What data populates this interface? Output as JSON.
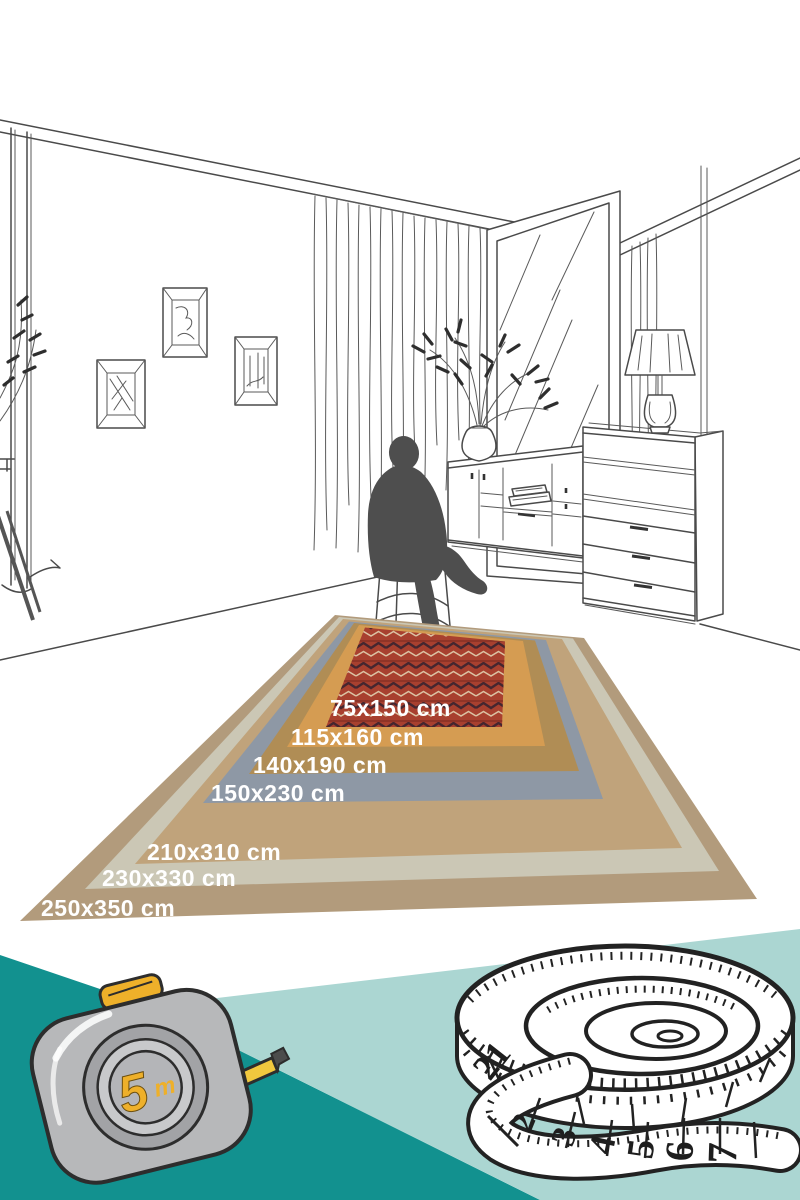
{
  "rugs": [
    {
      "label": "250x350 cm",
      "color": "#b29b7c"
    },
    {
      "label": "230x330 cm",
      "color": "#cbc7b5"
    },
    {
      "label": "210x310 cm",
      "color": "#c0a37b"
    },
    {
      "label": "150x230 cm",
      "color": "#8e98a5"
    },
    {
      "label": "140x190 cm",
      "color": "#b08d55"
    },
    {
      "label": "115x160 cm",
      "color": "#d59c52"
    },
    {
      "label": "75x150 cm",
      "color": "#a8402f"
    }
  ],
  "rug_pattern": {
    "dark": "#45262f",
    "light": "#dcc3a4",
    "band": "#8c3126"
  },
  "scene": {
    "line_color": "#4a4a4a",
    "silhouette_color": "#4e4e4e"
  },
  "bottom_band": {
    "dark_teal": "#12918f",
    "light_teal": "#abd6d2",
    "tape_measure": {
      "number": "5",
      "unit": "m",
      "body_color": "#b7b8ba",
      "accent_color": "#eeb02a"
    },
    "measuring_tape": {
      "coil_numbers": [
        "21",
        "22"
      ],
      "tail_numbers": [
        "2",
        "3",
        "4",
        "5",
        "6",
        "7"
      ]
    }
  }
}
